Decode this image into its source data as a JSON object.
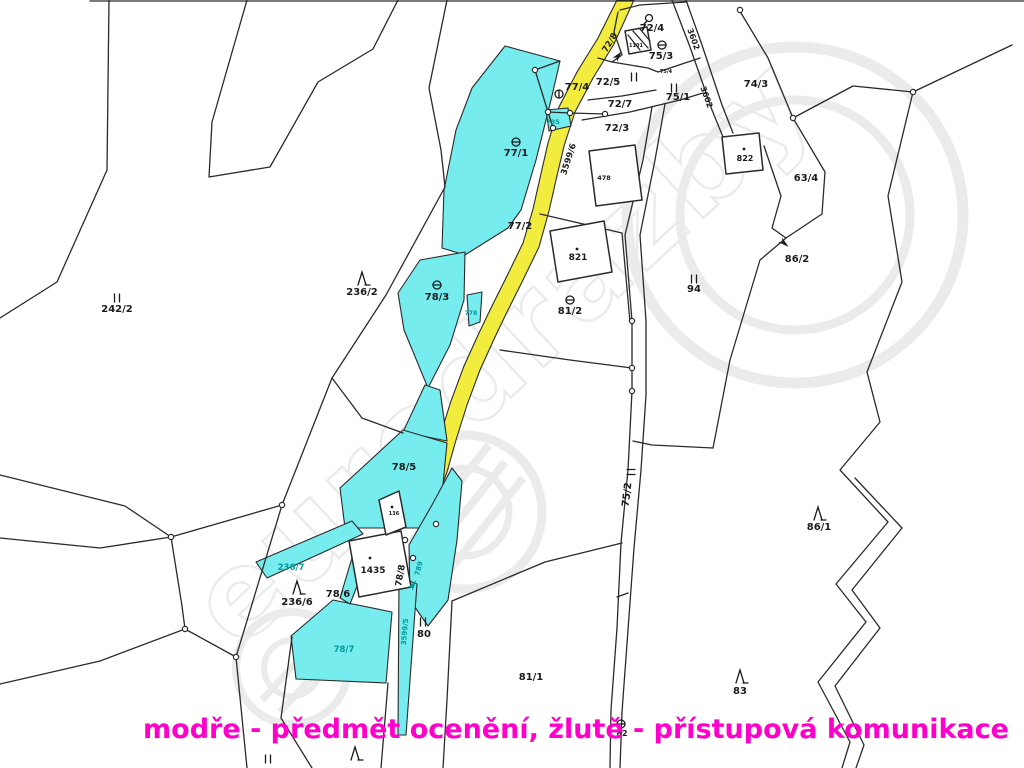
{
  "caption": {
    "text": "modře - předmět ocenění, žlutě - přístupová komunikace"
  },
  "watermark": {
    "text": "eurodrazby"
  },
  "colors": {
    "subject": "#76ecef",
    "road": "#f2ec3e",
    "line": "#2a2a2a",
    "teal": "#009a9a",
    "caption": "#ff00cb",
    "watermark": "#d8d8d8"
  },
  "map": {
    "labels": [
      {
        "text": "72/4",
        "x": 652,
        "y": 31
      },
      {
        "text": "75/3",
        "x": 661,
        "y": 59
      },
      {
        "text": "74/3",
        "x": 756,
        "y": 87
      },
      {
        "text": "77/4",
        "x": 577,
        "y": 90
      },
      {
        "text": "72/5",
        "x": 608,
        "y": 85
      },
      {
        "text": "75/1",
        "x": 678,
        "y": 100
      },
      {
        "text": "72/7",
        "x": 620,
        "y": 107
      },
      {
        "text": "72/3",
        "x": 617,
        "y": 131
      },
      {
        "text": "77/1",
        "x": 516,
        "y": 156
      },
      {
        "text": "77/2",
        "x": 520,
        "y": 229
      },
      {
        "text": "236/2",
        "x": 362,
        "y": 295
      },
      {
        "text": "78/3",
        "x": 437,
        "y": 300
      },
      {
        "text": "242/2",
        "x": 117,
        "y": 312
      },
      {
        "text": "94",
        "x": 694,
        "y": 292
      },
      {
        "text": "63/4",
        "x": 806,
        "y": 181
      },
      {
        "text": "86/2",
        "x": 797,
        "y": 262
      },
      {
        "text": "822",
        "x": 745,
        "y": 161,
        "size": 8
      },
      {
        "text": "821",
        "x": 578,
        "y": 260,
        "size": 9
      },
      {
        "text": "478",
        "x": 604,
        "y": 180,
        "size": 6.5
      },
      {
        "text": "1101",
        "x": 636,
        "y": 47,
        "size": 5
      },
      {
        "text": "75/4",
        "x": 666,
        "y": 73,
        "size": 5
      },
      {
        "text": "86/1",
        "x": 819,
        "y": 530
      },
      {
        "text": "78/5",
        "x": 404,
        "y": 470
      },
      {
        "text": "136",
        "x": 394,
        "y": 515,
        "size": 5
      },
      {
        "text": "1435",
        "x": 373,
        "y": 573,
        "size": 9
      },
      {
        "text": "78/6",
        "x": 338,
        "y": 597
      },
      {
        "text": "236/6",
        "x": 297,
        "y": 605
      },
      {
        "text": "81/2",
        "x": 570,
        "y": 314
      },
      {
        "text": "81/1",
        "x": 531,
        "y": 680
      },
      {
        "text": "83",
        "x": 740,
        "y": 694
      },
      {
        "text": "82",
        "x": 622,
        "y": 736,
        "size": 8
      },
      {
        "text": "80",
        "x": 424,
        "y": 637
      },
      {
        "text": "75/2",
        "x": 630,
        "y": 495,
        "rot": -83
      },
      {
        "text": "78/8",
        "x": 403,
        "y": 576,
        "rot": -80,
        "size": 9
      },
      {
        "text": "3599/6",
        "x": 571,
        "y": 160,
        "rot": -72,
        "size": 8.5
      },
      {
        "text": "3602",
        "x": 691,
        "y": 40,
        "rot": 70,
        "size": 8
      },
      {
        "text": "3602",
        "x": 704,
        "y": 98,
        "rot": 70,
        "size": 8
      },
      {
        "text": "72/8",
        "x": 612,
        "y": 44,
        "rot": -58,
        "size": 8.5
      },
      {
        "text": "735",
        "x": 553,
        "y": 124,
        "size": 6.5,
        "c": "t"
      },
      {
        "text": "778",
        "x": 471,
        "y": 315,
        "size": 6,
        "c": "t"
      },
      {
        "text": "789",
        "x": 421,
        "y": 569,
        "rot": -75,
        "size": 7,
        "c": "t"
      },
      {
        "text": "3599/5",
        "x": 407,
        "y": 632,
        "rot": -85,
        "size": 7,
        "c": "t"
      },
      {
        "text": "236/7",
        "x": 291,
        "y": 570,
        "size": 8.5,
        "c": "t"
      },
      {
        "text": "78/7",
        "x": 344,
        "y": 652,
        "size": 8.5,
        "c": "t"
      }
    ],
    "symbols": [
      {
        "type": "theta",
        "x": 662,
        "y": 45
      },
      {
        "type": "theta",
        "x": 516,
        "y": 142
      },
      {
        "type": "theta",
        "x": 437,
        "y": 285
      },
      {
        "type": "theta",
        "x": 570,
        "y": 300
      },
      {
        "type": "theta",
        "x": 621,
        "y": 724
      },
      {
        "type": "phi",
        "x": 559,
        "y": 94
      },
      {
        "type": "circle-stem",
        "x": 649,
        "y": 18
      },
      {
        "type": "II",
        "x": 674,
        "y": 88
      },
      {
        "type": "II",
        "x": 634,
        "y": 77
      },
      {
        "type": "II",
        "x": 694,
        "y": 279
      },
      {
        "type": "II",
        "x": 117,
        "y": 298
      },
      {
        "type": "II",
        "x": 423,
        "y": 622
      },
      {
        "type": "II",
        "x": 268,
        "y": 759
      },
      {
        "type": "equals",
        "x": 631,
        "y": 472
      },
      {
        "type": "tree",
        "x": 362,
        "y": 279
      },
      {
        "type": "tree",
        "x": 297,
        "y": 588
      },
      {
        "type": "tree",
        "x": 818,
        "y": 514
      },
      {
        "type": "tree",
        "x": 740,
        "y": 677
      },
      {
        "type": "tree",
        "x": 355,
        "y": 754
      },
      {
        "type": "dot",
        "x": 577,
        "y": 249
      },
      {
        "type": "dot",
        "x": 370,
        "y": 558
      },
      {
        "type": "dot",
        "x": 392,
        "y": 507
      },
      {
        "type": "dot",
        "x": 744,
        "y": 149
      },
      {
        "type": "arrow",
        "x": 618,
        "y": 56,
        "rot": -50
      },
      {
        "type": "arrow",
        "x": 784,
        "y": 243,
        "rot": 40
      },
      {
        "type": "arrow",
        "x": 413,
        "y": 585,
        "rot": -55,
        "c": "t"
      }
    ],
    "points": [
      [
        535,
        70
      ],
      [
        548,
        112
      ],
      [
        570,
        113
      ],
      [
        605,
        114
      ],
      [
        553,
        128
      ],
      [
        632,
        321
      ],
      [
        632,
        368
      ],
      [
        632,
        391
      ],
      [
        282,
        505
      ],
      [
        171,
        537
      ],
      [
        185,
        629
      ],
      [
        236,
        657
      ],
      [
        405,
        540
      ],
      [
        413,
        558
      ],
      [
        436,
        524
      ],
      [
        740,
        10
      ],
      [
        913,
        92
      ],
      [
        793,
        118
      ]
    ]
  }
}
